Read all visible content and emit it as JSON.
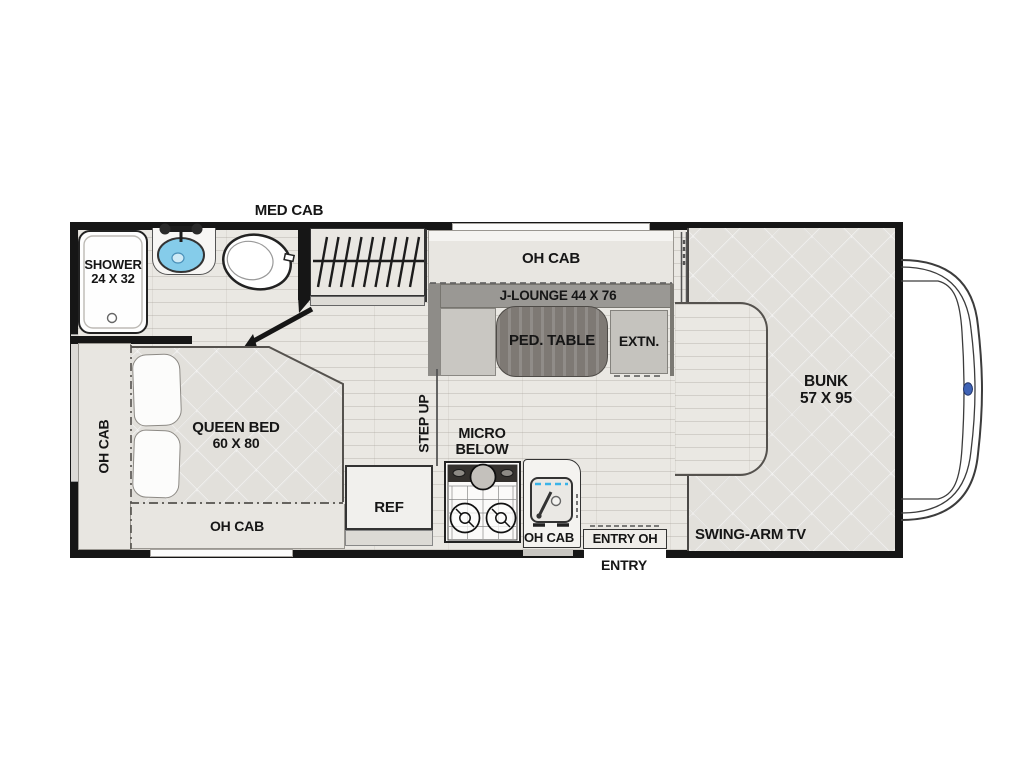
{
  "plan": {
    "labels": {
      "med_cab": "MED CAB",
      "shower_l1": "SHOWER",
      "shower_l2": "24 X 32",
      "oh_cab_dinette": "OH CAB",
      "j_lounge": "J-LOUNGE 44 X 76",
      "ped_table": "PED. TABLE",
      "extn": "EXTN.",
      "bunk_l1": "BUNK",
      "bunk_l2": "57 X 95",
      "swing_arm_tv": "SWING-ARM TV",
      "oh_cab_left": "OH CAB",
      "queen_bed_l1": "QUEEN BED",
      "queen_bed_l2": "60 X 80",
      "oh_cab_bed": "OH CAB",
      "step_up": "STEP UP",
      "micro_l1": "MICRO",
      "micro_l2": "BELOW",
      "ref": "REF",
      "oh_cab_kitchen": "OH CAB",
      "entry_oh": "ENTRY OH",
      "entry": "ENTRY"
    },
    "colors": {
      "wall": "#161616",
      "floor": "#eae8e3",
      "mattress": "#e2e0db",
      "lounge_gray": "#9a9894",
      "table_wood": "#7e7974",
      "bath_sink_blue": "#85ccea",
      "kitchen_sink_accent": "#3ab3e8",
      "ford_logo_blue": "#3f63b5"
    }
  }
}
